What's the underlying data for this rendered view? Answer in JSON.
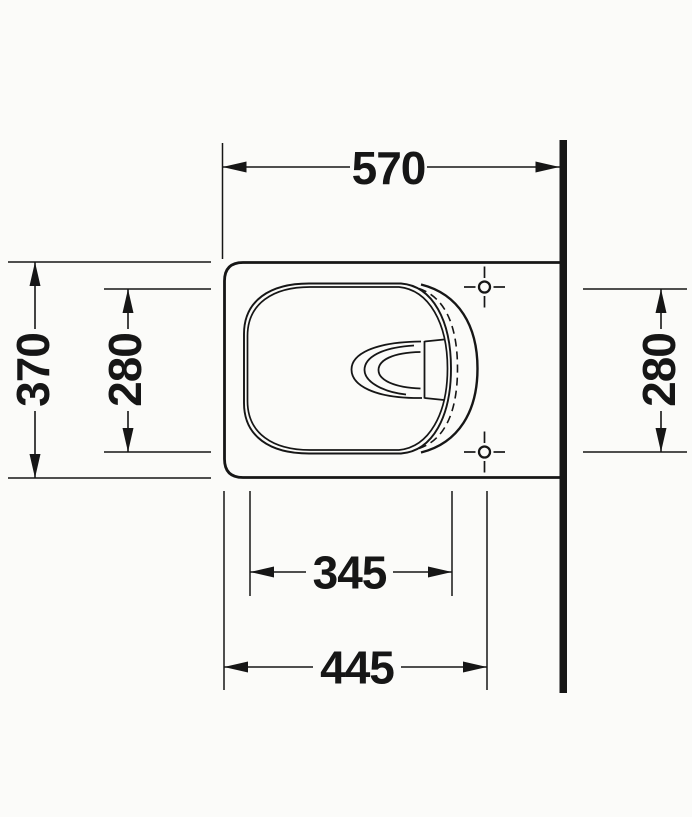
{
  "drawing": {
    "subject": "wall-hung toilet plan view technical drawing",
    "background_color": "#fbfbf9",
    "line_color": "#161616",
    "wall_side": "right",
    "mounting_points_count": "2",
    "dimensions": {
      "depth_overall": "570",
      "width_overall": "370",
      "width_inner": "280",
      "hole_spacing": "280",
      "length_inner": "345",
      "length_front_to_holes": "445"
    }
  }
}
